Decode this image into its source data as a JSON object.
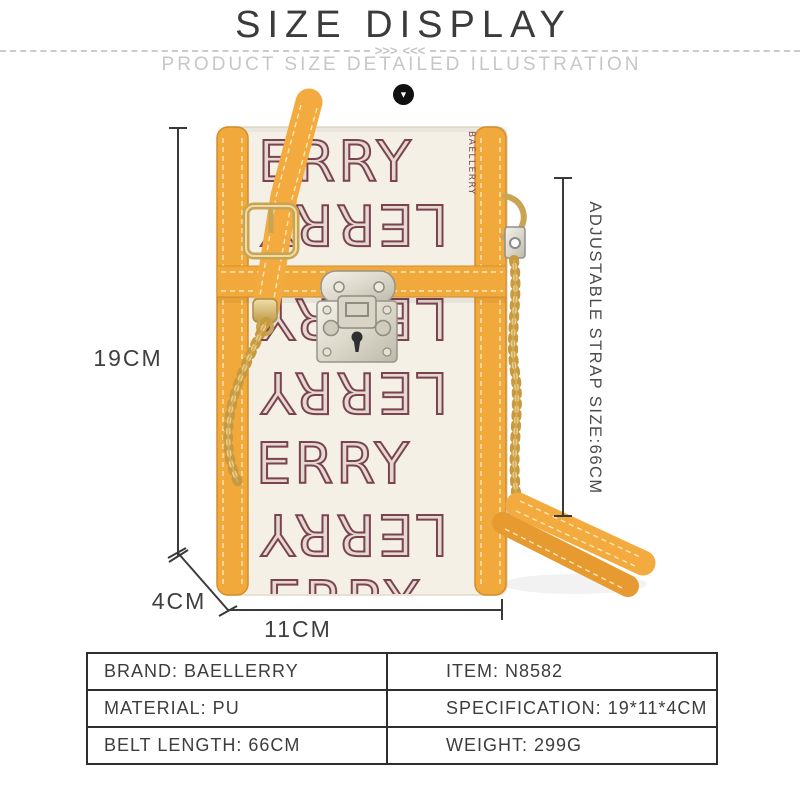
{
  "header": {
    "title": "SIZE DISPLAY",
    "subtitle": "PRODUCT SIZE DETAILED ILLUSTRATION",
    "arrows_left": ">>>",
    "arrows_right": "<<<",
    "down_arrow": "▼"
  },
  "illustration": {
    "dimensions": {
      "height_label": "19CM",
      "depth_label": "4CM",
      "width_label": "11CM",
      "strap_label": "ADJUSTABLE STRAP SIZE:66CM"
    },
    "bag": {
      "side_print": "BAELLERRY",
      "pattern_rows": [
        "ERRY",
        "LERRY",
        "LERRY",
        "LERRY",
        "ERRY",
        "LERRY",
        "ERRY"
      ],
      "colors": {
        "trim_yellow": "#F2A93C",
        "body_cream": "#F5F0E6",
        "print_maroon": "#7B4350",
        "hardware_gold": "#C9A553",
        "hardware_silver": "#D8D4C6",
        "chain_gold": "#CFA24C"
      }
    }
  },
  "spec_table": {
    "rows": [
      {
        "left": "BRAND: BAELLERRY",
        "right": "ITEM: N8582"
      },
      {
        "left": "MATERIAL: PU",
        "right": "SPECIFICATION: 19*11*4CM"
      },
      {
        "left": "BELT LENGTH: 66CM",
        "right": "WEIGHT: 299G"
      }
    ]
  }
}
